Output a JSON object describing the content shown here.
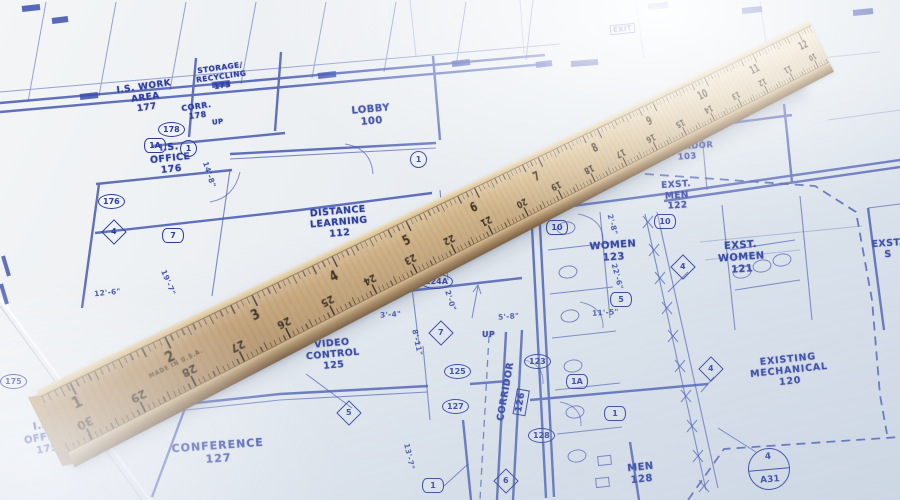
{
  "blueprint": {
    "rooms": {
      "is_work_area": "I.S. WORK\nAREA\n177",
      "storage_recycling": "STORAGE/\nRECYCLING\n173",
      "corr": "CORR.\n178",
      "is_office_upper": "I.S.\nOFFICE\n176",
      "lobby": "LOBBY\n100",
      "coats_vending": "COATS/\nVENDING",
      "distance_learning": "DISTANCE\nLEARNING\n112",
      "corridor_103": "CORRIDOR\n103",
      "exst_men": "EXST.\nMEN\n122",
      "exst_women": "EXST.\nWOMEN\n121",
      "women": "WOMEN\n123",
      "exst_s": "EXST.\nS",
      "video_control": "VIDEO\nCONTROL\n125",
      "corridor_126": "CORRIDOR",
      "corridor_126_num": "126",
      "conference": "CONFERENCE\n127",
      "men": "MEN\n128",
      "existing_mechanical": "EXISTING\nMECHANICAL\n120",
      "is_office_lower": "I.S.\nOFFICE\n175",
      "up_1": "UP",
      "up_2": "UP",
      "exit_1": "EXIT"
    },
    "markers": {
      "oval_175": "175",
      "oval_176": "176",
      "oval_178": "178",
      "oval_124a": "124A",
      "oval_125": "125",
      "oval_127": "127",
      "oval_123": "123",
      "oval_128": "128",
      "dia_4_office": "4",
      "dia_7_center": "7",
      "dia_5": "5",
      "dia_6": "6",
      "dia_4_exstw": "4",
      "dia_4_mech": "4",
      "hex_1a_office": "1A",
      "hex_7_office": "7",
      "hex_1a_men": "1A",
      "hex_1_men": "1",
      "hex_1_conf": "1",
      "hex_10_women": "10",
      "hex_5_women": "5",
      "hex_10_exst": "10",
      "circ_1_office": "1",
      "circ_1_lobby": "1",
      "detail_top": "4",
      "detail_bottom": "A31"
    },
    "dimensions": {
      "d12_6": "12'-6\"",
      "d19_7": "19'-7\"",
      "d14_8": "14'-8\"",
      "d14_9": "14'-9\"",
      "d8_11": "8'-11\"",
      "d13_7": "13'-7\"",
      "d3_4": "3'-4\"",
      "d2_0": "2'-0\"",
      "d5_8": "5'-8\"",
      "d11_5": "11'-5\"",
      "d22_6": "22'-6\"",
      "d2_8": "2'-8\""
    }
  },
  "ruler": {
    "inch_numbers": [
      "1",
      "2",
      "3",
      "4",
      "5",
      "6",
      "7",
      "8",
      "9",
      "10",
      "11",
      "12"
    ],
    "cm_numbers": [
      "30",
      "29",
      "28",
      "27",
      "26",
      "25",
      "24",
      "23",
      "22",
      "21",
      "20",
      "19",
      "18",
      "17",
      "16",
      "15",
      "14",
      "13",
      "12",
      "11",
      "10"
    ],
    "made_in": "MADE IN U.S.A."
  },
  "colors": {
    "ink": "#2c3da0",
    "paper": "#eef1f4",
    "wood": "#cfae80"
  }
}
